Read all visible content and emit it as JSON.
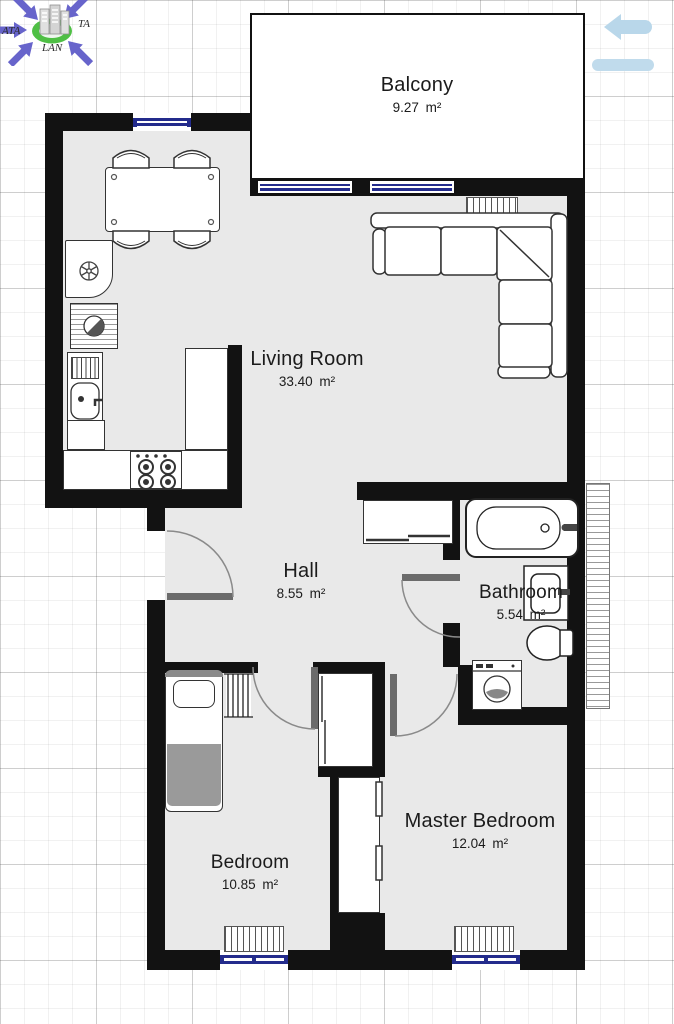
{
  "logo": {
    "text_left": "ATA",
    "text_right": "TA",
    "text_bottom": "LAN"
  },
  "rooms": {
    "balcony": {
      "name": "Balcony",
      "area": "9.27 m²"
    },
    "living_room": {
      "name": "Living Room",
      "area": "33.40 m²"
    },
    "hall": {
      "name": "Hall",
      "area": "8.55 m²"
    },
    "bathroom": {
      "name": "Bathroom",
      "area": "5.54 m²"
    },
    "bedroom": {
      "name": "Bedroom",
      "area": "10.85 m²"
    },
    "master_bedroom": {
      "name": "Master Bedroom",
      "area": "12.04 m²"
    }
  },
  "colors": {
    "wall": "#121212",
    "floor": "#e9e9e9",
    "window_glass": "#232b8c",
    "door_leaf": "#6b6b6b",
    "blanket": "#9a9a9a",
    "nav_arrow": "#b9d7ea",
    "logo_purple": "#6764cb",
    "logo_green": "#4fbf45"
  }
}
